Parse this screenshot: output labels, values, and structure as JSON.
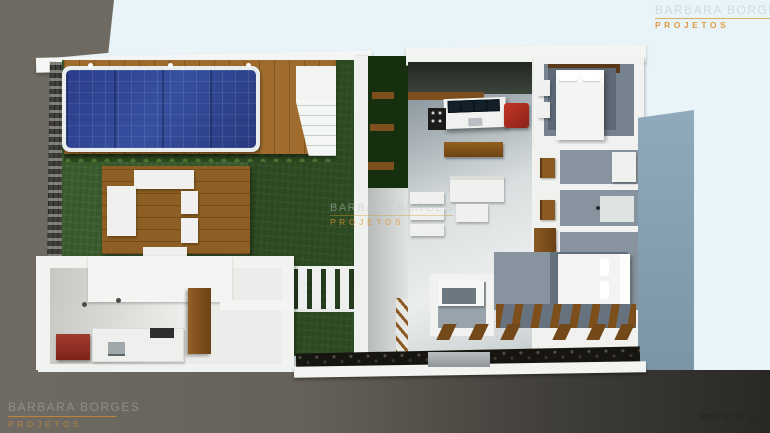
{
  "watermarks": {
    "top_right": {
      "name": "BARBARA BORGES",
      "tagline": "PROJETOS"
    },
    "center": {
      "name": "BARBARA BORGES",
      "tagline": "PROJETOS"
    },
    "bottom_left": {
      "name": "BARBARA BORGES",
      "tagline": "PROJETOS"
    },
    "bottom_right": {
      "label": "PROJETO 21"
    }
  },
  "palette": {
    "background_sky": "#e9f4f8",
    "surround_gray": "#6e6a61",
    "pool_water_blue": "#2b3d8a",
    "lawn_green": "#3b5e2e",
    "deck_wood_brown": "#a06c2d",
    "accent_orange": "#d9983f",
    "interior_floor_gray": "#87939e",
    "furniture_red": "#b03028",
    "driveway_blue_gray": "#8aa4b6"
  }
}
